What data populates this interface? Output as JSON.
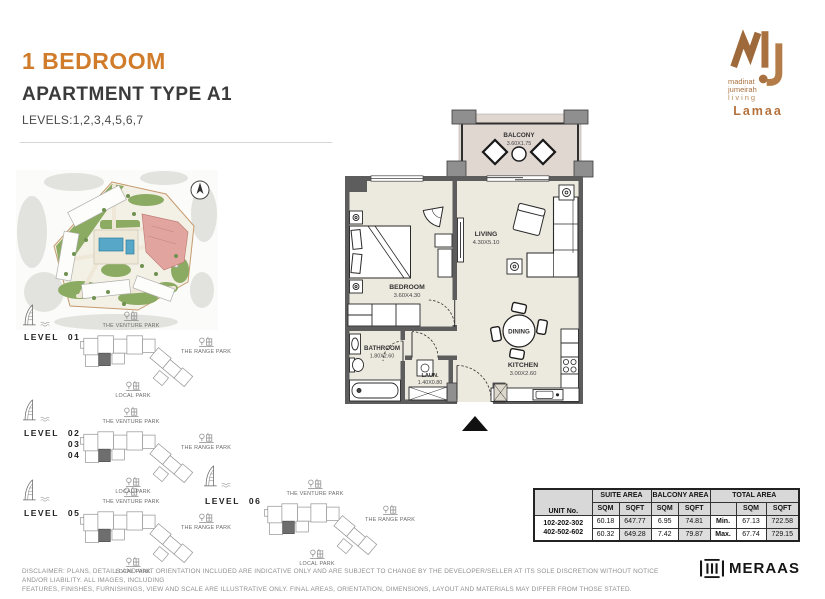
{
  "header": {
    "title": "1 BEDROOM",
    "subtitle": "APARTMENT TYPE A1",
    "levels": "LEVELS:1,2,3,4,5,6,7"
  },
  "brand": {
    "line1": "madinat",
    "line2": "jumeirah",
    "line3": "living",
    "project": "Lamaa"
  },
  "floor_plan": {
    "balcony": {
      "name": "BALCONY",
      "dims": "3.60X1.75"
    },
    "living": {
      "name": "LIVING",
      "dims": "4.30X5.10"
    },
    "bedroom": {
      "name": "BEDROOM",
      "dims": "3.60X4.30"
    },
    "bathroom": {
      "name": "BATHROOM",
      "dims": "1.80X2.60"
    },
    "laundry": {
      "name": "LAUN.",
      "dims": "1.40X0.80"
    },
    "dining": {
      "name": "DINING"
    },
    "kitchen": {
      "name": "KITCHEN",
      "dims": "3.00X2.60"
    }
  },
  "site_plan": {
    "parks": {
      "venture": "THE VENTURE PARK",
      "range": "THE RANGE PARK",
      "local": "LOCAL PARK"
    },
    "levels": [
      {
        "label": "LEVEL",
        "n1": "01"
      },
      {
        "label": "LEVEL",
        "n1": "02",
        "n2": "03",
        "n3": "04"
      },
      {
        "label": "LEVEL",
        "n1": "05"
      },
      {
        "label": "LEVEL",
        "n1": "06"
      }
    ]
  },
  "area_table": {
    "unit_header": "UNIT No.",
    "suite_header": "SUITE AREA",
    "balcony_header": "BALCONY AREA",
    "total_header": "TOTAL AREA",
    "sqm": "SQM",
    "sqft": "SQFT",
    "unit_line1": "102-202-302",
    "unit_line2": "402-502-602",
    "rows": [
      {
        "suite_sqm": "60.18",
        "suite_sqft": "647.77",
        "balcony_sqm": "6.95",
        "balcony_sqft": "74.81",
        "bound": "Min.",
        "total_sqm": "67.13",
        "total_sqft": "722.58"
      },
      {
        "suite_sqm": "60.32",
        "suite_sqft": "649.28",
        "balcony_sqm": "7.42",
        "balcony_sqft": "79.87",
        "bound": "Max.",
        "total_sqm": "67.74",
        "total_sqft": "729.15"
      }
    ]
  },
  "footer": {
    "disclaimer_line1": "DISCLAIMER: PLANS, DETAILS AND UNIT ORIENTATION INCLUDED ARE INDICATIVE ONLY AND ARE SUBJECT TO CHANGE BY THE DEVELOPER/SELLER AT ITS SOLE DISCRETION WITHOUT NOTICE AND/OR LIABILITY. ALL IMAGES, INCLUDING",
    "disclaimer_line2": "FEATURES, FINISHES, FURNISHINGS, VIEW AND SCALE ARE ILLUSTRATIVE ONLY. FINAL AREAS, ORIENTATION, DIMENSIONS, LAYOUT AND MATERIALS MAY DIFFER FROM THOSE STATED.",
    "developer": "MERAAS"
  },
  "colors": {
    "accent_orange": "#D07C2B",
    "logo_copper": "#A9713F",
    "wall_gray": "#5D5D5D",
    "floor_cream": "#ECE9DE",
    "balcony_floor": "#E1D7D1",
    "highlight_pink": "#E2A49E"
  }
}
